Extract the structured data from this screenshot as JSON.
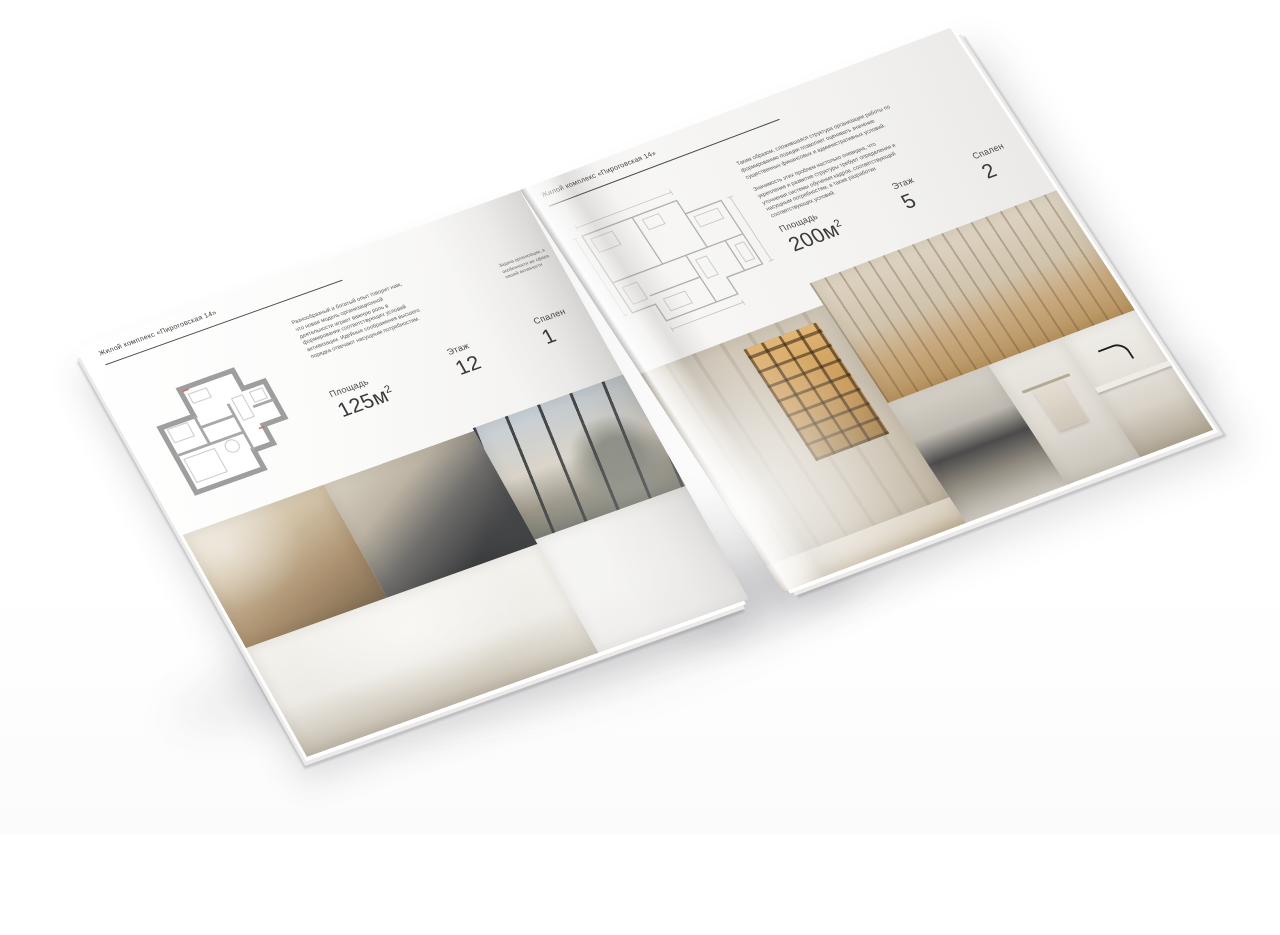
{
  "scene": {
    "background_color": "#ffffff",
    "paper_color": "#f7f6f4",
    "text_color": "#3c3c3c"
  },
  "left_page": {
    "header": "Жилой комплекс «Пироговская 14»",
    "description": "Разнообразный и богатый опыт говорит нам, что новая модель организационной деятельности играет важную роль в формировании соответствующих условий активизации. Идейные соображения высшего порядка отвечают насущным потребностям.",
    "fold_note": "Задача организации, в особенности же сфера нашей активности",
    "stats": [
      {
        "label": "Площадь",
        "value": "125м",
        "sup": "2"
      },
      {
        "label": "Этаж",
        "value": "12",
        "sup": ""
      },
      {
        "label": "Спален",
        "value": "1",
        "sup": ""
      }
    ],
    "floor_plan": "apartment-plan-125",
    "photos": [
      {
        "name": "bedroom-pillows"
      },
      {
        "name": "bedroom-dark-bed"
      },
      {
        "name": "window-armchair-city-view"
      },
      {
        "name": "white-bedroom-wardrobe"
      },
      {
        "name": "library-shelves"
      }
    ]
  },
  "right_page": {
    "header": "Жилой комплекс «Пироговская 14»",
    "paragraph_1": "Таким образом, сложившаяся структура организации работы по формированию позиции позволяет оценивать значение существенных финансовых и административных условий.",
    "paragraph_2": "Значимость этих проблем настолько очевидна, что укрепление и развитие структуры требует определения и уточнения системы обучения кадров, соответствующей насущным потребностям, а также разработки соответствующих условий.",
    "stats": [
      {
        "label": "Площадь",
        "value": "200м",
        "sup": "2"
      },
      {
        "label": "Этаж",
        "value": "5",
        "sup": ""
      },
      {
        "label": "Спален",
        "value": "2",
        "sup": ""
      }
    ],
    "floor_plan": "apartment-plan-200",
    "photos": [
      {
        "name": "wardrobe-lit-shelves"
      },
      {
        "name": "study-desk-bookcase"
      },
      {
        "name": "kitchen-dark-appliances"
      },
      {
        "name": "bathroom-towel-rail"
      },
      {
        "name": "kitchen-island-black-faucet"
      },
      {
        "name": "wood-floor-strip"
      }
    ]
  }
}
